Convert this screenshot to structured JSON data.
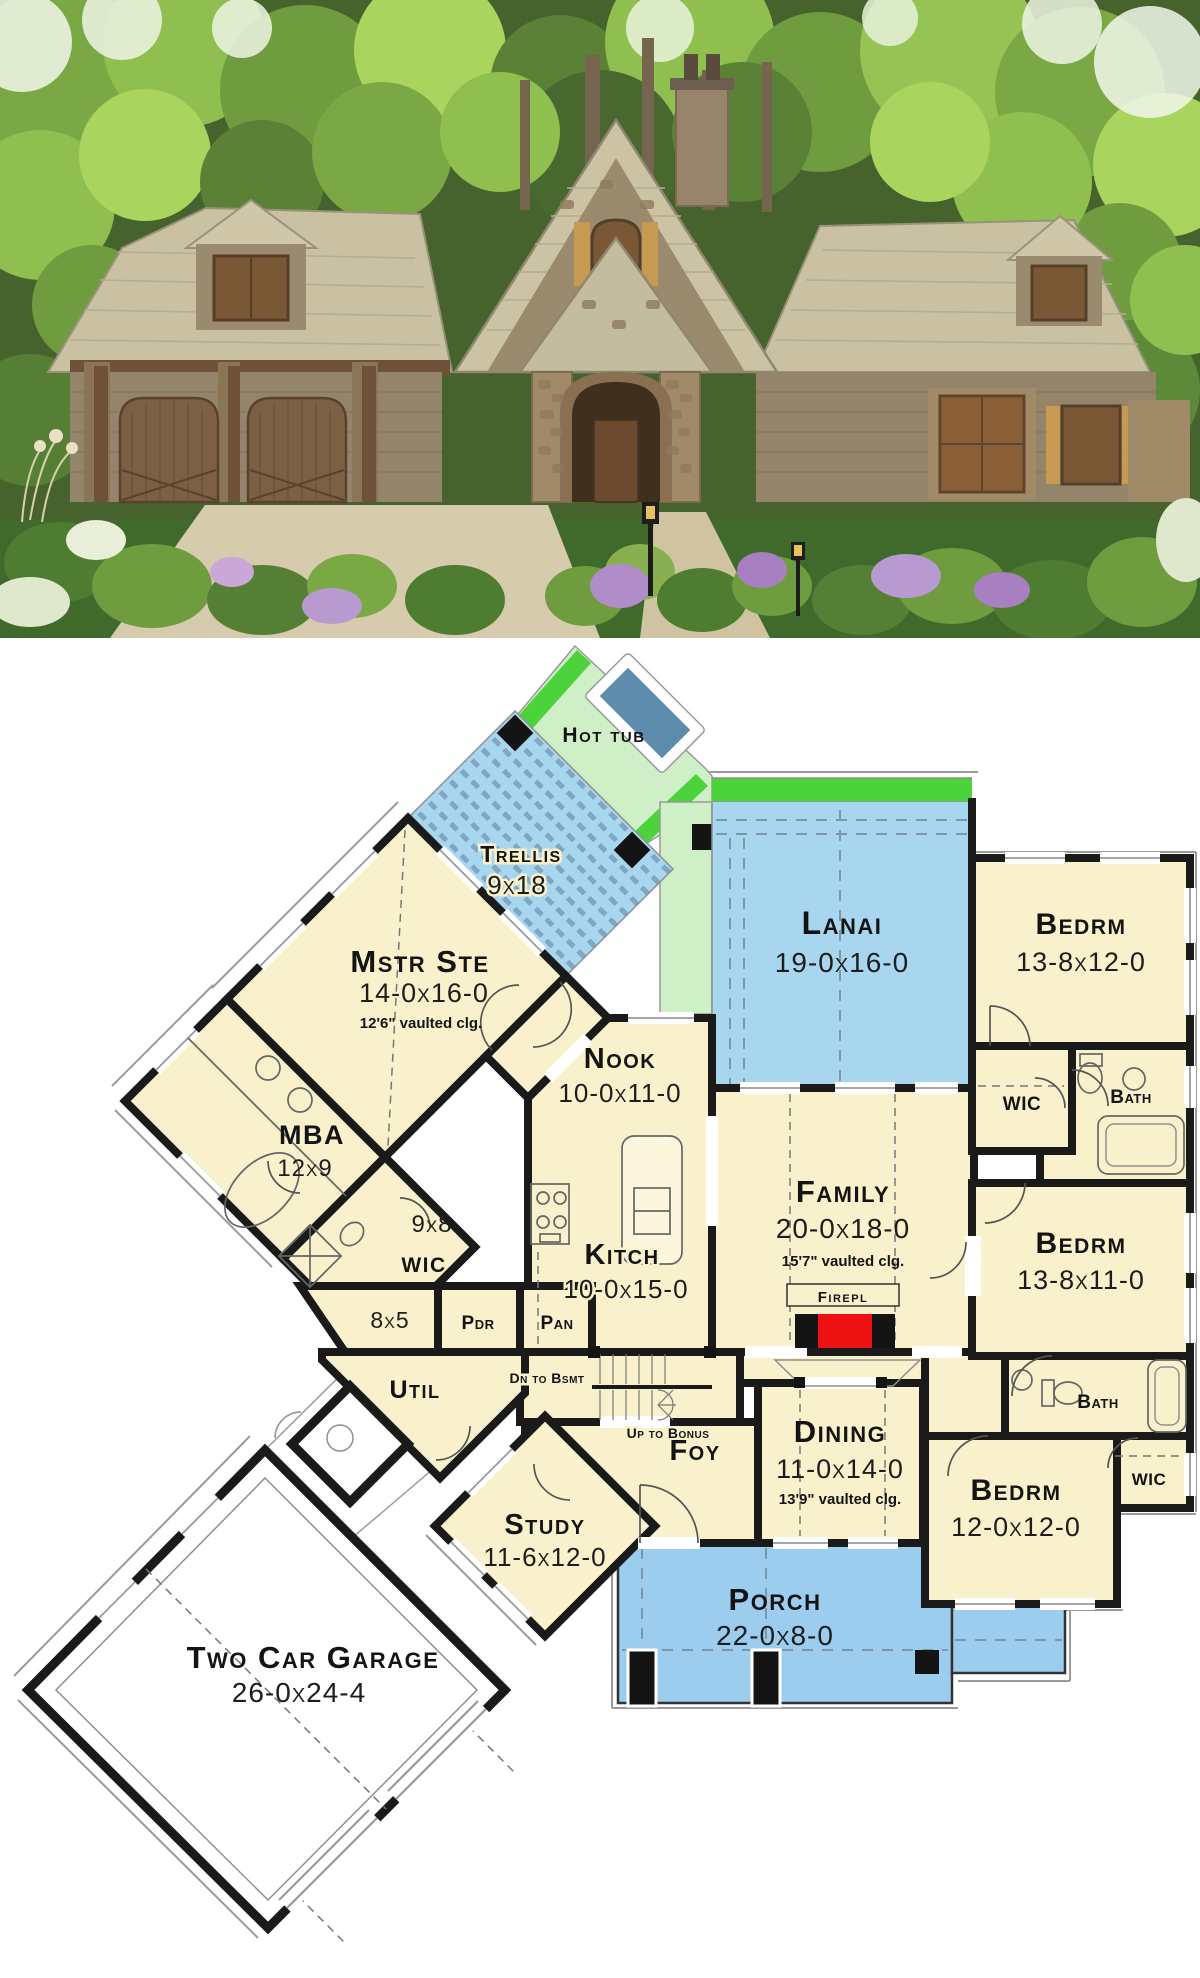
{
  "palette": {
    "room_fill": "#F8F1CB",
    "outdoor_blue": "#A9D6EF",
    "trellis_stripe_blue": "#7FA6C2",
    "deck_green_light": "#CFEFC7",
    "deck_green_bright": "#4CD33B",
    "hot_tub_blue": "#5E8CAD",
    "wall_black": "#1A1A1A",
    "fireplace_red": "#EE1111",
    "photo_foliage_green": "#6F9C3F",
    "photo_roof_tan": "#C9C1A2",
    "photo_stone": "#A69178",
    "photo_wood_brown": "#7A5C3F",
    "photo_grass": "#3F6A2B",
    "photo_lavender": "#B08CC8"
  },
  "plan": {
    "hot_tub": {
      "name": "Hot tub"
    },
    "trellis": {
      "name": "Trellis",
      "dims": "9x18"
    },
    "lanai": {
      "name": "Lanai",
      "dims": "19-0x16-0"
    },
    "bedrm_top": {
      "name": "Bedrm",
      "dims": "13-8x12-0"
    },
    "wic_top": {
      "name": "WIC"
    },
    "bath_top": {
      "name": "Bath"
    },
    "mstr": {
      "name": "Mstr Ste",
      "dims": "14-0x16-0",
      "note": "12'6\" vaulted clg."
    },
    "nook": {
      "name": "Nook",
      "dims": "10-0x11-0"
    },
    "mba": {
      "name": "MBA",
      "dims": "12x9"
    },
    "wic_mstr": {
      "name": "WIC",
      "dims": "9x8"
    },
    "kitch": {
      "name": "Kitch",
      "dims": "10-0x15-0"
    },
    "family": {
      "name": "Family",
      "dims": "20-0x18-0",
      "note": "15'7\" vaulted clg."
    },
    "bedrm_mid": {
      "name": "Bedrm",
      "dims": "13-8x11-0"
    },
    "closet": {
      "dims": "8x5"
    },
    "pdr": {
      "name": "Pdr"
    },
    "pan": {
      "name": "Pan"
    },
    "util": {
      "name": "Util"
    },
    "firepl": {
      "name": "Firepl"
    },
    "stairs_dn": {
      "label": "Dn to Bsmt"
    },
    "stairs_up": {
      "label": "Up to Bonus"
    },
    "bath_mid": {
      "name": "Bath"
    },
    "wic_mid": {
      "name": "WIC"
    },
    "foy": {
      "name": "Foy"
    },
    "dining": {
      "name": "Dining",
      "dims": "11-0x14-0",
      "note": "13'9\" vaulted clg."
    },
    "bedrm_bottom": {
      "name": "Bedrm",
      "dims": "12-0x12-0"
    },
    "study": {
      "name": "Study",
      "dims": "11-6x12-0"
    },
    "porch": {
      "name": "Porch",
      "dims": "22-0x8-0"
    },
    "garage": {
      "name": "Two Car Garage",
      "dims": "26-0x24-4"
    }
  }
}
